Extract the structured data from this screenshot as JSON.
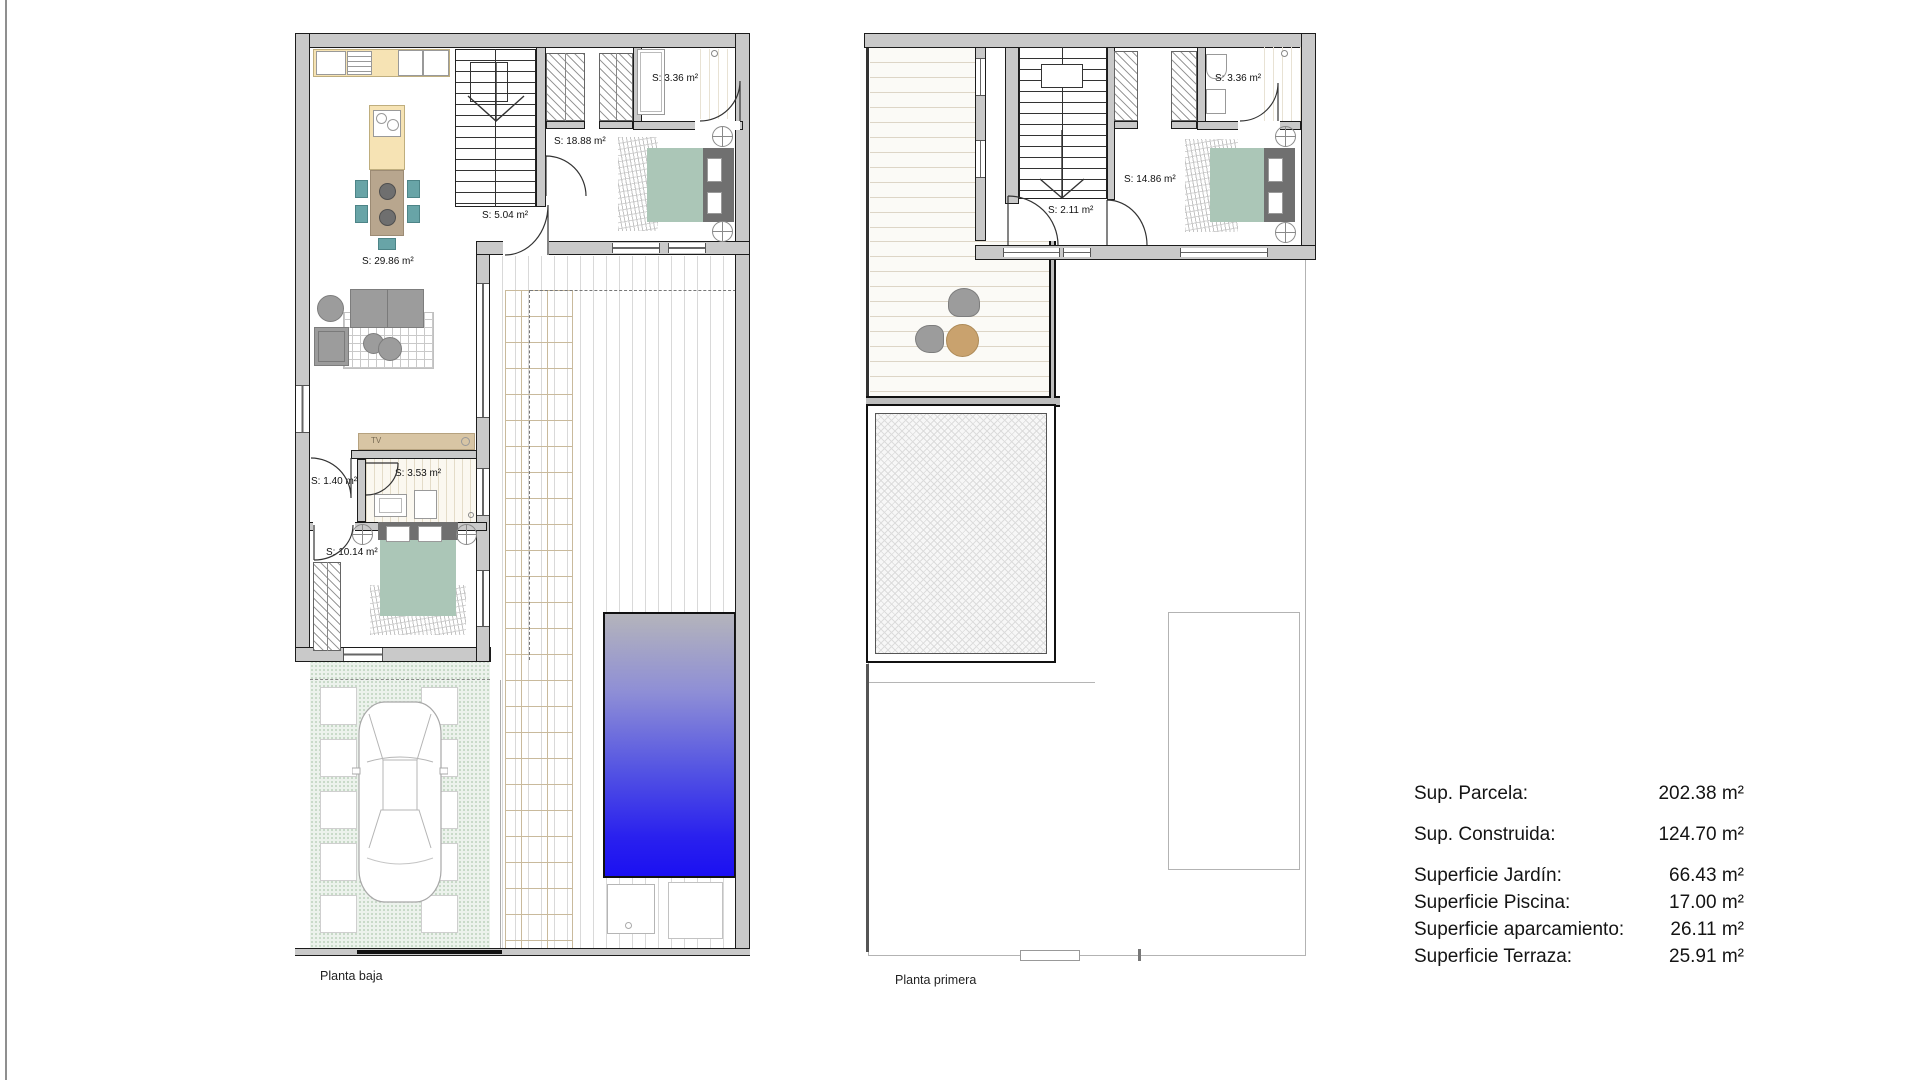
{
  "ground": {
    "name": "Planta baja",
    "labels": {
      "bath_top": "S: 3.36 m²",
      "bedroom": "S: 18.88 m²",
      "entry": "S: 5.04 m²",
      "living": "S: 29.86 m²",
      "bath": "S: 3.53 m²",
      "hall": "S: 1.40 m²",
      "bedroom2": "S: 10.14 m²",
      "tv": "TV"
    }
  },
  "first": {
    "name": "Planta primera",
    "labels": {
      "bath": "S: 3.36 m²",
      "bedroom": "S: 14.86 m²",
      "hall": "S: 2.11 m²"
    }
  },
  "summary": {
    "rows": [
      {
        "label": "Sup. Parcela:",
        "value": "202.38 m²"
      },
      {
        "label": "Sup. Construida:",
        "value": "124.70 m²"
      },
      {
        "label": "Superficie Jardín:",
        "value": "66.43 m²"
      },
      {
        "label": "Superficie Piscina:",
        "value": "17.00 m²"
      },
      {
        "label": "Superficie aparcamiento:",
        "value": "26.11 m²"
      },
      {
        "label": "Superficie Terraza:",
        "value": "25.91 m²"
      }
    ]
  }
}
